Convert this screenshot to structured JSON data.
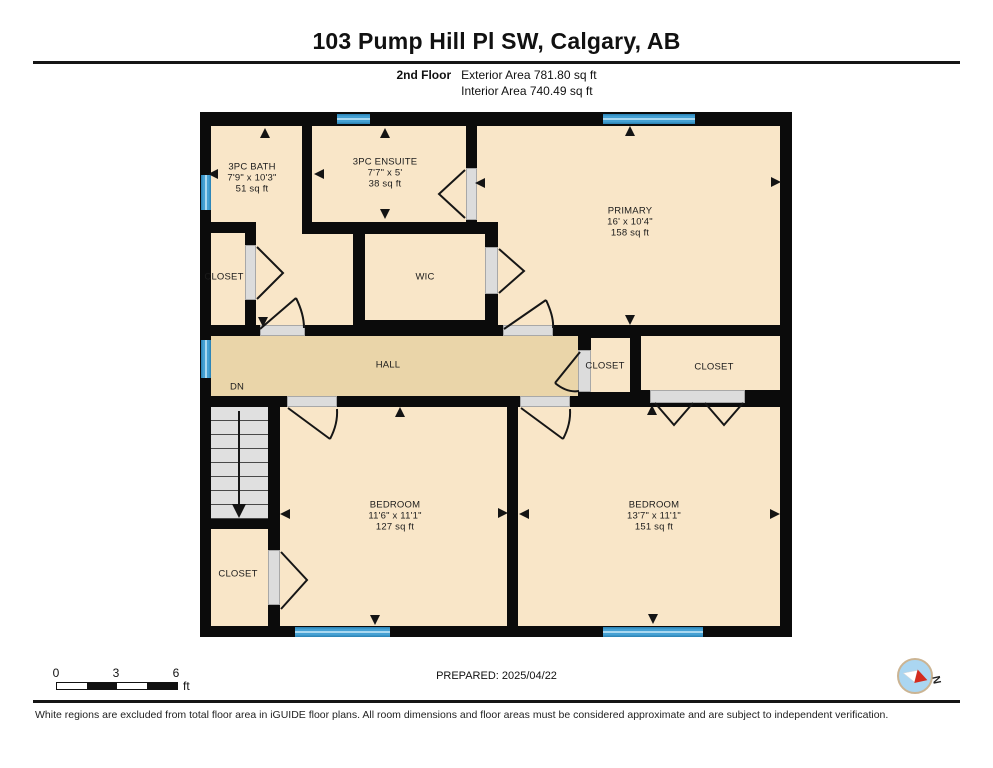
{
  "header": {
    "title": "103 Pump Hill Pl SW, Calgary, AB",
    "floor_label": "2nd Floor",
    "exterior_area": "Exterior Area 781.80 sq ft",
    "interior_area": "Interior Area 740.49 sq ft"
  },
  "rooms": {
    "bath": {
      "name": "3PC BATH",
      "dims": "7'9\" x 10'3\"",
      "area": "51 sq ft"
    },
    "ensuite": {
      "name": "3PC ENSUITE",
      "dims": "7'7\" x 5'",
      "area": "38 sq ft"
    },
    "primary": {
      "name": "PRIMARY",
      "dims": "16' x 10'4\"",
      "area": "158 sq ft"
    },
    "wic": {
      "name": "WIC"
    },
    "hall": {
      "name": "HALL",
      "stairs_label": "DN"
    },
    "closet_bath": {
      "name": "CLOSET"
    },
    "closet_hall_small": {
      "name": "CLOSET"
    },
    "closet_hall_large": {
      "name": "CLOSET"
    },
    "closet_lower": {
      "name": "CLOSET"
    },
    "bedroom_left": {
      "name": "BEDROOM",
      "dims": "11'6\" x 11'1\"",
      "area": "127 sq ft"
    },
    "bedroom_right": {
      "name": "BEDROOM",
      "dims": "13'7\" x 11'1\"",
      "area": "151 sq ft"
    }
  },
  "footer": {
    "scale": {
      "tick_0": "0",
      "tick_3": "3",
      "tick_6": "6",
      "unit": "ft"
    },
    "prepared": "PREPARED: 2025/04/22",
    "compass_label": "N",
    "disclaimer": "White regions are excluded from total floor area in iGUIDE floor plans. All room dimensions and floor areas must be considered approximate and are subject to independent verification."
  },
  "colors": {
    "wall": "#0b0b0b",
    "room_fill": "#f9e6c8",
    "hall_fill": "#ead5a9",
    "window_blue": "#45a1d4",
    "door_gray": "#dcdcdc",
    "stair_gray": "#e0e0e0",
    "compass_red": "#d42b1e",
    "compass_blue": "#abd6f1"
  }
}
